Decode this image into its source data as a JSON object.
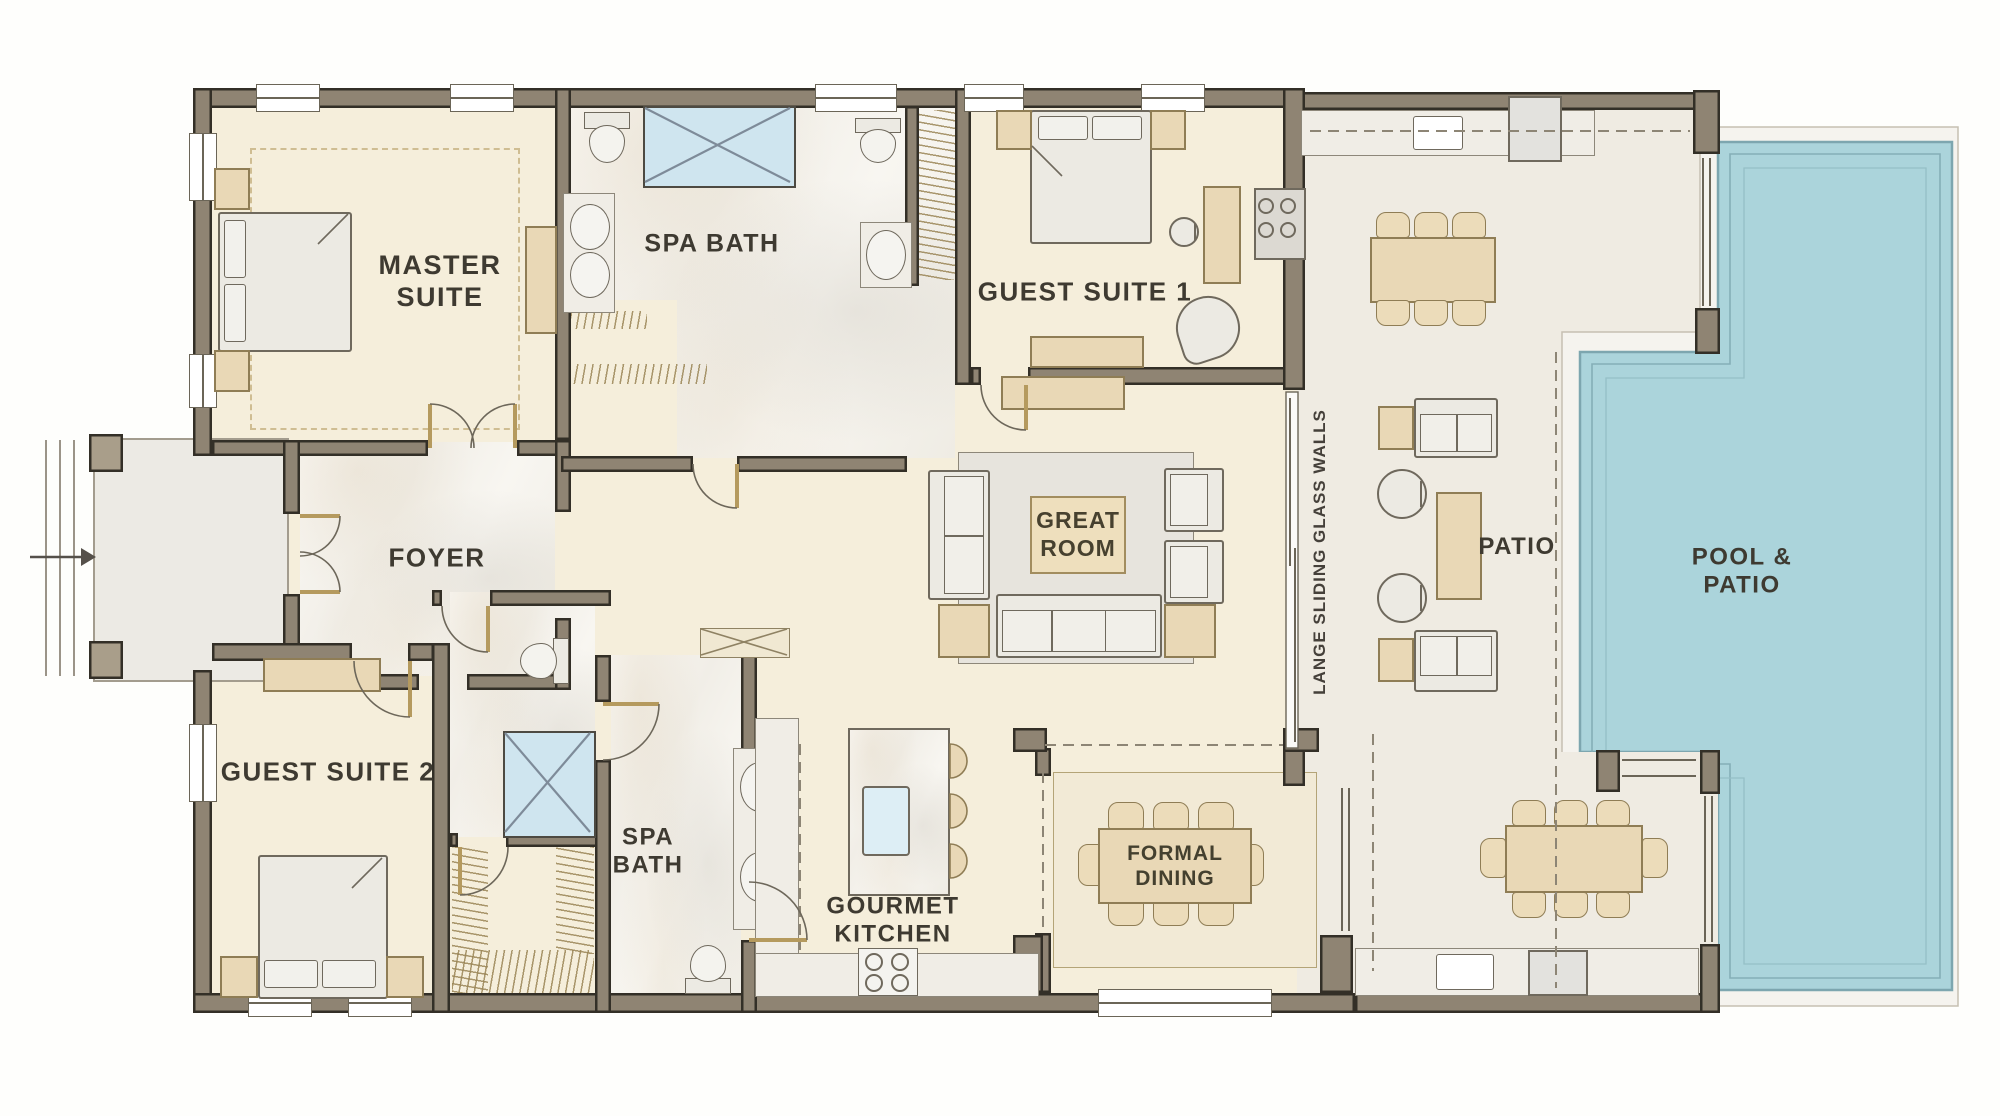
{
  "title": "Single-story luxury house floor plan with pool",
  "labels": {
    "master_suite": {
      "line1": "MASTER",
      "line2": "SUITE"
    },
    "spa_bath_upper": {
      "line1": "SPA BATH"
    },
    "guest_suite_1": {
      "line1": "GUEST SUITE 1"
    },
    "foyer": {
      "line1": "FOYER"
    },
    "great_room": {
      "line1": "GREAT",
      "line2": "ROOM"
    },
    "guest_suite_2": {
      "line1": "GUEST SUITE 2"
    },
    "spa_bath_lower": {
      "line1": "SPA",
      "line2": "BATH"
    },
    "gourmet_kitchen": {
      "line1": "GOURMET",
      "line2": "KITCHEN"
    },
    "formal_dining": {
      "line1": "FORMAL",
      "line2": "DINING"
    },
    "patio": {
      "line1": "PATIO"
    },
    "pool_patio": {
      "line1": "POOL &",
      "line2": "PATIO"
    },
    "sliding_glass_note": {
      "line1": "LANGE SLIDING GLASS WALLS"
    }
  },
  "colors": {
    "wall": "#8f8473",
    "wall_outline": "#332f27",
    "room_cream": "#f5eedb",
    "marble": "#f6f4ef",
    "patio_floor": "#efebe2",
    "pool_water": "#abd4db",
    "pool_deck": "#f5f3ee",
    "furniture_tan": "#e9d8b6",
    "furniture_gray": "#eceae3",
    "shower_blue": "#cfe5ef",
    "text": "#3e3a31"
  }
}
